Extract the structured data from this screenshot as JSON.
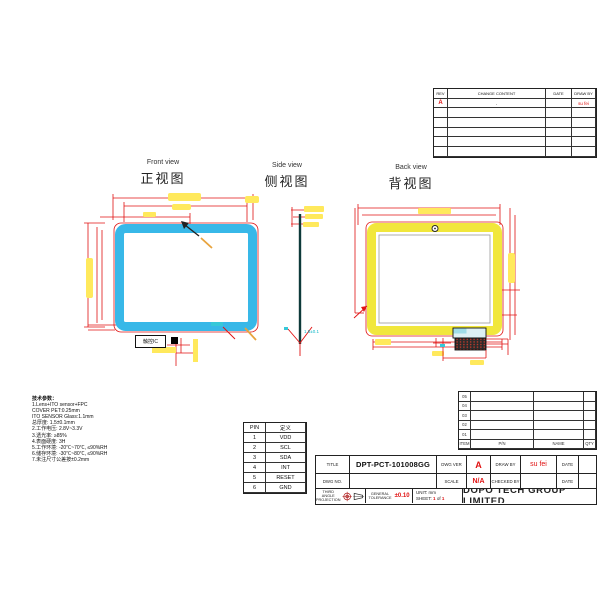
{
  "views": {
    "front": {
      "en": "Front view",
      "zh": "正视图"
    },
    "side": {
      "en": "Side view",
      "zh": "侧视图"
    },
    "back": {
      "en": "Back view",
      "zh": "背视图"
    }
  },
  "drawing": {
    "ic_label": "触控IC",
    "side_note": "1.5±0.1"
  },
  "tech_params": {
    "title": "技术参数：",
    "lines": [
      "1.Lens+ITO sensor+FPC",
      "COVER PET:0.25mm",
      "ITO SENSOR Glass:1.1mm",
      "总厚度: 1.5±0.1mm",
      "2.工作电压: 2.8V~3.3V",
      "3.透光率: ≥85%",
      "4.表面硬度: 3H",
      "5.工作环境: -20℃~70℃, ≤90%RH",
      "6.储存环境: -30℃~80℃, ≤90%RH",
      "7.未注尺寸公差按±0.2mm"
    ]
  },
  "pin_table": {
    "headers": [
      "PIN",
      "定义"
    ],
    "rows": [
      [
        "1",
        "VDD"
      ],
      [
        "2",
        "SCL"
      ],
      [
        "3",
        "SDA"
      ],
      [
        "4",
        "INT"
      ],
      [
        "5",
        "RESET"
      ],
      [
        "6",
        "GND"
      ]
    ]
  },
  "revision_table": {
    "headers": [
      "REV",
      "CHANGE CONTENT",
      "DATE",
      "DRAW BY"
    ],
    "first_row": {
      "rev": "A",
      "content": "-",
      "date": "",
      "draw_by": "su fei"
    }
  },
  "bom_table": {
    "items": [
      "05",
      "04",
      "03",
      "02",
      "01"
    ],
    "footer": [
      "ITEM",
      "P/N",
      "NAME",
      "QTY"
    ]
  },
  "title_block": {
    "title_label": "TITLE",
    "title": "DPT-PCT-101008GG",
    "dwg_ver_label": "DWG VER",
    "dwg_ver": "A",
    "draw_by_label": "DRAW BY",
    "draw_by": "su fei",
    "date_label": "DATE",
    "dwg_no_label": "DWG NO.",
    "scale_label": "SCALE",
    "scale": "N/A",
    "checked_by_label": "CHECKED BY",
    "projection_line1": "THIRD ANGLE",
    "projection_line2": "PROJECTION",
    "tolerance_line1": "GENERAL",
    "tolerance_line2": "TOLERANCE",
    "tolerance": "±0.10",
    "unit": "UNIT: mm",
    "sheet_label": "SHEET:",
    "sheet_page": "1",
    "sheet_of": "of",
    "sheet_total": "1",
    "company": "DOPO TECH GROUP LIMITED"
  },
  "colors": {
    "dimension_red": "#e01212",
    "panel_cyan": "#38b8e8",
    "highlight_yellow": "#ffe95c",
    "back_panel_yellow": "#f1e73c",
    "annotation_cyan": "#10b8c8",
    "accent_text_red": "#e01212"
  }
}
